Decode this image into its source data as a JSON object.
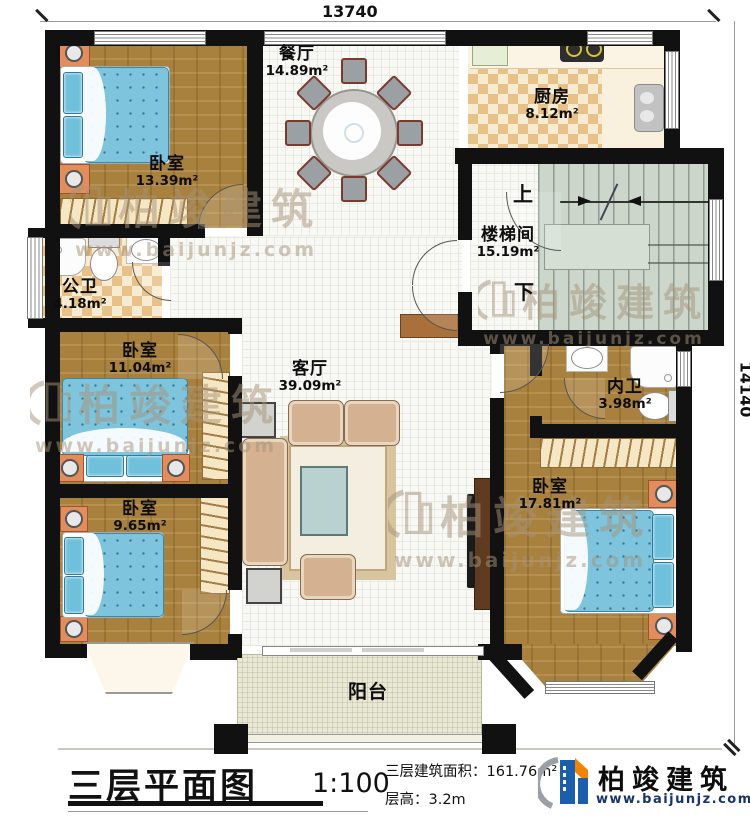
{
  "plan": {
    "dimension_top": "13740",
    "dimension_right": "14140",
    "rooms": [
      {
        "key": "bedroom-1",
        "name": "卧室",
        "area": "13.39m²"
      },
      {
        "key": "dining",
        "name": "餐厅",
        "area": "14.89m²"
      },
      {
        "key": "kitchen",
        "name": "厨房",
        "area": "8.12m²"
      },
      {
        "key": "stairwell",
        "name": "楼梯间",
        "area": "15.19m²"
      },
      {
        "key": "public-bathroom",
        "name": "公卫",
        "area": "4.18m²"
      },
      {
        "key": "bedroom-2",
        "name": "卧室",
        "area": "11.04m²"
      },
      {
        "key": "living-room",
        "name": "客厅",
        "area": "39.09m²"
      },
      {
        "key": "inner-bathroom",
        "name": "内卫",
        "area": "3.98m²"
      },
      {
        "key": "bedroom-3",
        "name": "卧室",
        "area": "17.81m²"
      },
      {
        "key": "bedroom-4",
        "name": "卧室",
        "area": "9.65m²"
      },
      {
        "key": "balcony",
        "name": "阳台",
        "area": ""
      }
    ],
    "stair_up": "上",
    "stair_down": "下"
  },
  "titleblock": {
    "title": "三层平面图",
    "scale": "1:100",
    "area_line": "三层建筑面积：161.76m²",
    "height_line": "层高：3.2m"
  },
  "brand": {
    "name": "柏竣建筑",
    "url": "www.baijunjz.com"
  },
  "colors": {
    "wall": "#111111",
    "wood_floor": "#a8813f",
    "bed_blue": "#7ec4dc",
    "stair_floor": "#ccd6cb",
    "checker_tan": "#e8c188",
    "balcony_floor": "#e9e8d4",
    "logo_blue": "#1b5eab",
    "logo_orange": "#f08300",
    "watermark": "#a6937a"
  }
}
